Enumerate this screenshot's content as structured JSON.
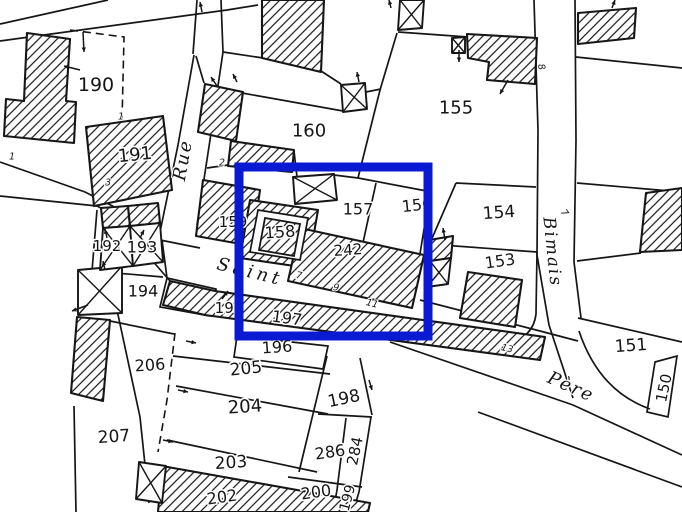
{
  "map": {
    "width": 682,
    "height": 512,
    "background": "#ffffff",
    "ink": "#161616"
  },
  "highlight": {
    "name": "selection-rectangle",
    "color": "#0a19d2",
    "x": 239,
    "y": 167,
    "width": 189,
    "height": 169,
    "stroke_width": 9
  },
  "parcel_labels": [
    {
      "label": "190",
      "x": 96,
      "y": 85,
      "size": 19,
      "rot": 0
    },
    {
      "label": "191",
      "x": 135,
      "y": 155,
      "size": 18,
      "rot": -6
    },
    {
      "label": "192",
      "x": 107,
      "y": 246,
      "size": 15,
      "rot": 0
    },
    {
      "label": "193",
      "x": 142,
      "y": 247,
      "size": 16,
      "rot": 0
    },
    {
      "label": "194",
      "x": 143,
      "y": 291,
      "size": 16,
      "rot": 0
    },
    {
      "label": "195",
      "x": 229,
      "y": 308,
      "size": 15,
      "rot": 0
    },
    {
      "label": "196",
      "x": 277,
      "y": 347,
      "size": 16,
      "rot": -4
    },
    {
      "label": "197",
      "x": 287,
      "y": 318,
      "size": 16,
      "rot": 8
    },
    {
      "label": "198",
      "x": 344,
      "y": 399,
      "size": 17,
      "rot": -12
    },
    {
      "label": "199",
      "x": 348,
      "y": 498,
      "size": 14,
      "rot": -75
    },
    {
      "label": "200",
      "x": 316,
      "y": 492,
      "size": 16,
      "rot": -8
    },
    {
      "label": "202",
      "x": 222,
      "y": 497,
      "size": 16,
      "rot": -8
    },
    {
      "label": "203",
      "x": 231,
      "y": 463,
      "size": 17,
      "rot": -4
    },
    {
      "label": "204",
      "x": 245,
      "y": 407,
      "size": 18,
      "rot": -4
    },
    {
      "label": "205",
      "x": 246,
      "y": 369,
      "size": 17,
      "rot": -6
    },
    {
      "label": "206",
      "x": 150,
      "y": 365,
      "size": 16,
      "rot": -4
    },
    {
      "label": "207",
      "x": 114,
      "y": 437,
      "size": 17,
      "rot": -4
    },
    {
      "label": "242",
      "x": 348,
      "y": 250,
      "size": 15,
      "rot": -4
    },
    {
      "label": "284",
      "x": 355,
      "y": 451,
      "size": 15,
      "rot": -78
    },
    {
      "label": "286",
      "x": 330,
      "y": 452,
      "size": 16,
      "rot": -8
    },
    {
      "label": "150",
      "x": 664,
      "y": 388,
      "size": 15,
      "rot": -78
    },
    {
      "label": "151",
      "x": 631,
      "y": 346,
      "size": 17,
      "rot": -4
    },
    {
      "label": "153",
      "x": 500,
      "y": 261,
      "size": 16,
      "rot": -8
    },
    {
      "label": "154",
      "x": 499,
      "y": 213,
      "size": 17,
      "rot": -4
    },
    {
      "label": "155",
      "x": 456,
      "y": 108,
      "size": 18,
      "rot": 0
    },
    {
      "label": "156",
      "x": 417,
      "y": 205,
      "size": 16,
      "rot": -6
    },
    {
      "label": "157",
      "x": 358,
      "y": 209,
      "size": 16,
      "rot": 0
    },
    {
      "label": "158",
      "x": 280,
      "y": 232,
      "size": 16,
      "rot": -4
    },
    {
      "label": "159",
      "x": 233,
      "y": 222,
      "size": 15,
      "rot": 0
    },
    {
      "label": "160",
      "x": 309,
      "y": 131,
      "size": 18,
      "rot": 0
    }
  ],
  "street_labels": [
    {
      "name": "Rue",
      "x": 183,
      "y": 160,
      "size": 18,
      "rot": -80,
      "spacing": 2
    },
    {
      "name": "Saint",
      "x": 250,
      "y": 272,
      "size": 18,
      "rot": 14,
      "spacing": 4
    },
    {
      "name": "Père",
      "x": 571,
      "y": 387,
      "size": 18,
      "rot": 24,
      "spacing": 2
    },
    {
      "name": "Bimais",
      "x": 552,
      "y": 252,
      "size": 17,
      "rot": 84,
      "spacing": 2
    }
  ],
  "house_numbers": [
    {
      "text": "1",
      "x": 12,
      "y": 157,
      "rot": 0
    },
    {
      "text": "1",
      "x": 121,
      "y": 117,
      "rot": 0
    },
    {
      "text": "2",
      "x": 222,
      "y": 163,
      "rot": 0
    },
    {
      "text": "3",
      "x": 108,
      "y": 183,
      "rot": 0
    },
    {
      "text": "7",
      "x": 299,
      "y": 276,
      "rot": 10
    },
    {
      "text": "9",
      "x": 336,
      "y": 288,
      "rot": 10
    },
    {
      "text": "11",
      "x": 372,
      "y": 304,
      "rot": 15
    },
    {
      "text": "13",
      "x": 507,
      "y": 349,
      "rot": 15
    },
    {
      "text": "7",
      "x": 564,
      "y": 213,
      "rot": 55
    },
    {
      "text": "8",
      "x": 541,
      "y": 67,
      "rot": 75
    }
  ],
  "geometry": {
    "boundary_lines": [
      "M0,24 L108,0",
      "M0,41 L227,10 L258,5",
      "M197,0 L193,54",
      "M221,0 L223,52",
      "M194,55 L178,145 L160,232",
      "M223,52 L210,140 L197,225",
      "M223,52 L263,58",
      "M321,71 L341,84",
      "M196,56 L204,83",
      "M242,93 L343,111",
      "M366,92 L381,89",
      "M397,33 L380,90 L358,178",
      "M398,32 L468,37",
      "M358,178 L432,192",
      "M456,183 L536,187",
      "M456,183 L430,243",
      "M376,183 L359,261",
      "M431,186 L419,260",
      "M428,244 L537,252",
      "M537,252 L536,314 Q533,339 505,343 L436,326",
      "M427,246 L429,287",
      "M534,0 L538,130 L537,255 L549,325 L573,398",
      "M575,0 L576,140 L574,262 L581,318",
      "M576,57 L682,68",
      "M577,183 L682,192",
      "M577,261 L641,253",
      "M578,318 L682,342",
      "M579,331 Q599,391 650,409",
      "M655,362 L677,356 L668,417 L647,412 Z",
      "M390,342 L573,405 L682,455",
      "M478,412 L682,487",
      "M540,331 L578,341",
      "M0,162 L85,192 L160,230",
      "M0,196 L97,206 L158,238",
      "M150,258 L170,281",
      "M97,210 L92,271",
      "M92,271 L163,277",
      "M162,240 L167,278",
      "M167,278 L216,289 L210,316 L160,307 Z",
      "M237,336 L328,346 L323,369 L234,357 Z",
      "M173,356 L330,374",
      "M176,386 L328,414",
      "M167,440 L317,472",
      "M327,356 L299,472",
      "M360,358 L372,415",
      "M318,414 L372,417",
      "M346,418 L337,490",
      "M371,417 L359,492",
      "M288,477 L362,487",
      "M337,490 L333,512 M359,492 L353,512",
      "M74,406 L76,512",
      "M117,310 L140,417 L149,503",
      "M110,321 L174,334",
      "M160,240 L200,248",
      "M420,300 L540,331",
      "M207,168 L228,165",
      "M294,151 L297,177",
      "M334,175 L358,178"
    ],
    "dashed_lines": [
      "M70,30 L124,37 L122,122",
      "M175,333 L167,400 L158,452"
    ],
    "hatched_buildings": [
      [
        [
          27,
          33
        ],
        [
          70,
          39
        ],
        [
          66,
          101
        ],
        [
          76,
          102
        ],
        [
          74,
          143
        ],
        [
          4,
          136
        ],
        [
          6,
          99
        ],
        [
          24,
          101
        ]
      ],
      [
        [
          86,
          127
        ],
        [
          163,
          116
        ],
        [
          172,
          190
        ],
        [
          94,
          206
        ]
      ],
      [
        [
          262,
          0
        ],
        [
          324,
          0
        ],
        [
          321,
          72
        ],
        [
          262,
          58
        ]
      ],
      [
        [
          205,
          84
        ],
        [
          243,
          92
        ],
        [
          236,
          141
        ],
        [
          198,
          132
        ]
      ],
      [
        [
          231,
          141
        ],
        [
          294,
          150
        ],
        [
          292,
          172
        ],
        [
          228,
          166
        ]
      ],
      [
        [
          203,
          180
        ],
        [
          260,
          190
        ],
        [
          252,
          246
        ],
        [
          196,
          236
        ]
      ],
      [
        [
          250,
          200
        ],
        [
          318,
          210
        ],
        [
          308,
          268
        ],
        [
          240,
          258
        ]
      ],
      [
        [
          300,
          228
        ],
        [
          424,
          255
        ],
        [
          412,
          308
        ],
        [
          288,
          281
        ]
      ],
      [
        [
          170,
          281
        ],
        [
          215,
          291
        ],
        [
          545,
          337
        ],
        [
          540,
          360
        ],
        [
          205,
          315
        ],
        [
          163,
          305
        ]
      ],
      [
        [
          468,
          272
        ],
        [
          522,
          280
        ],
        [
          515,
          327
        ],
        [
          460,
          318
        ]
      ],
      [
        [
          467,
          34
        ],
        [
          537,
          38
        ],
        [
          535,
          84
        ],
        [
          487,
          80
        ],
        [
          489,
          62
        ],
        [
          468,
          58
        ]
      ],
      [
        [
          578,
          13
        ],
        [
          636,
          8
        ],
        [
          634,
          38
        ],
        [
          578,
          44
        ]
      ],
      [
        [
          646,
          193
        ],
        [
          682,
          188
        ],
        [
          682,
          250
        ],
        [
          640,
          252
        ]
      ],
      [
        [
          77,
          317
        ],
        [
          110,
          320
        ],
        [
          103,
          401
        ],
        [
          71,
          393
        ]
      ],
      [
        [
          162,
          466
        ],
        [
          370,
          503
        ],
        [
          368,
          512
        ],
        [
          158,
          512
        ]
      ],
      [
        [
          101,
          208
        ],
        [
          128,
          206
        ],
        [
          130,
          226
        ],
        [
          103,
          228
        ]
      ],
      [
        [
          128,
          206
        ],
        [
          158,
          203
        ],
        [
          160,
          223
        ],
        [
          130,
          226
        ]
      ],
      [
        [
          429,
          240
        ],
        [
          453,
          236
        ],
        [
          451,
          258
        ],
        [
          430,
          261
        ]
      ]
    ],
    "white_courtyards": [
      [
        [
          258,
          210
        ],
        [
          308,
          218
        ],
        [
          300,
          260
        ],
        [
          250,
          252
        ]
      ]
    ],
    "hatched_overlays": [
      [
        [
          265,
          218
        ],
        [
          300,
          224
        ],
        [
          294,
          256
        ],
        [
          259,
          250
        ]
      ]
    ],
    "crossed_buildings": [
      [
        [
          341,
          85
        ],
        [
          365,
          83
        ],
        [
          367,
          109
        ],
        [
          343,
          112
        ]
      ],
      [
        [
          293,
          177
        ],
        [
          334,
          174
        ],
        [
          337,
          200
        ],
        [
          295,
          204
        ]
      ],
      [
        [
          400,
          0
        ],
        [
          424,
          0
        ],
        [
          422,
          28
        ],
        [
          398,
          30
        ]
      ],
      [
        [
          452,
          38
        ],
        [
          465,
          37
        ],
        [
          465,
          53
        ],
        [
          452,
          53
        ]
      ],
      [
        [
          78,
          270
        ],
        [
          122,
          266
        ],
        [
          122,
          313
        ],
        [
          78,
          315
        ]
      ],
      [
        [
          430,
          261
        ],
        [
          451,
          258
        ],
        [
          448,
          284
        ],
        [
          427,
          287
        ]
      ],
      [
        [
          103,
          228
        ],
        [
          130,
          226
        ],
        [
          133,
          266
        ],
        [
          100,
          270
        ]
      ],
      [
        [
          130,
          226
        ],
        [
          160,
          223
        ],
        [
          163,
          262
        ],
        [
          133,
          266
        ]
      ],
      [
        [
          139,
          462
        ],
        [
          166,
          466
        ],
        [
          162,
          503
        ],
        [
          136,
          499
        ]
      ]
    ],
    "arrows": [
      [
        83,
        32,
        84,
        52
      ],
      [
        80,
        70,
        64,
        66
      ],
      [
        217,
        86,
        211,
        77
      ],
      [
        237,
        82,
        233,
        74
      ],
      [
        359,
        82,
        357,
        72
      ],
      [
        391,
        8,
        389,
        0
      ],
      [
        459,
        50,
        459,
        62
      ],
      [
        508,
        80,
        500,
        94
      ],
      [
        445,
        240,
        443,
        228
      ],
      [
        612,
        8,
        615,
        0
      ],
      [
        107,
        238,
        105,
        229
      ],
      [
        140,
        238,
        144,
        230
      ],
      [
        105,
        270,
        103,
        261
      ],
      [
        88,
        305,
        72,
        311
      ],
      [
        222,
        299,
        228,
        291
      ],
      [
        186,
        341,
        196,
        343
      ],
      [
        178,
        390,
        188,
        392
      ],
      [
        163,
        440,
        173,
        442
      ],
      [
        369,
        380,
        372,
        390
      ],
      [
        202,
        12,
        200,
        2
      ]
    ]
  }
}
